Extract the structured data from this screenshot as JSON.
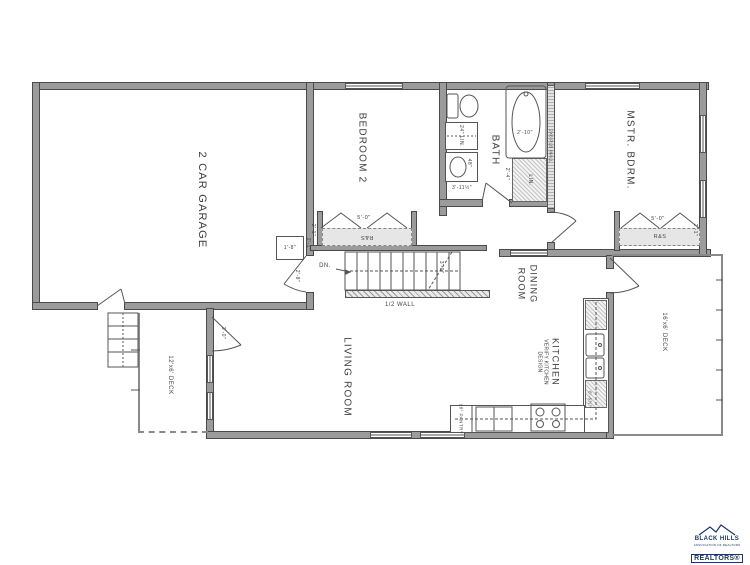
{
  "plan": {
    "rooms": {
      "garage": "2 CAR GARAGE",
      "bedroom2": "BEDROOM 2",
      "bath": "BATH",
      "master": "MSTR. BDRM.",
      "dining_line1": "DINING",
      "dining_line2": "ROOM",
      "kitchen": "KITCHEN",
      "kitchen_note1": "VERIFY KITCHEN",
      "kitchen_note2": "DESIGN",
      "living": "LIVING ROOM",
      "deck_left": "12'x6' DECK",
      "deck_right": "16'x6' DECK"
    },
    "labels": {
      "dn": "DN.",
      "half_wall": "1/2 WALL",
      "plb_wall": "2X6 PLB WALL",
      "lin_24": "24\" LIN.",
      "lin": "LIN.",
      "pantry": "18\" PANTRY",
      "rs_bedroom2": "R&S",
      "rs_master": "R&S"
    },
    "dims": {
      "closet_bedroom2_width": "5'-0\"",
      "closet_bedroom2_depth": "2'-1\"",
      "closet_master_width": "5'-0\"",
      "closet_master_depth": "2'-1\"",
      "hall_closet_width": "1'-8\"",
      "hall_closet_depth": "2'-1\"",
      "stair_width": "3'-0\"",
      "deck_door": "3'-0\"",
      "garage_door": "2'-8\"",
      "vanity": "48\"",
      "bath_wall": "3'-11½\"",
      "tub": "2'-10\"",
      "lin_depth": "2'-4\"",
      "counter": "6'-6½\""
    }
  },
  "logo": {
    "line1": "BLACK HILLS",
    "line2": "ASSOCIATION OF REALTORS",
    "line3": "REALTORS®",
    "color": "#1c3766"
  }
}
